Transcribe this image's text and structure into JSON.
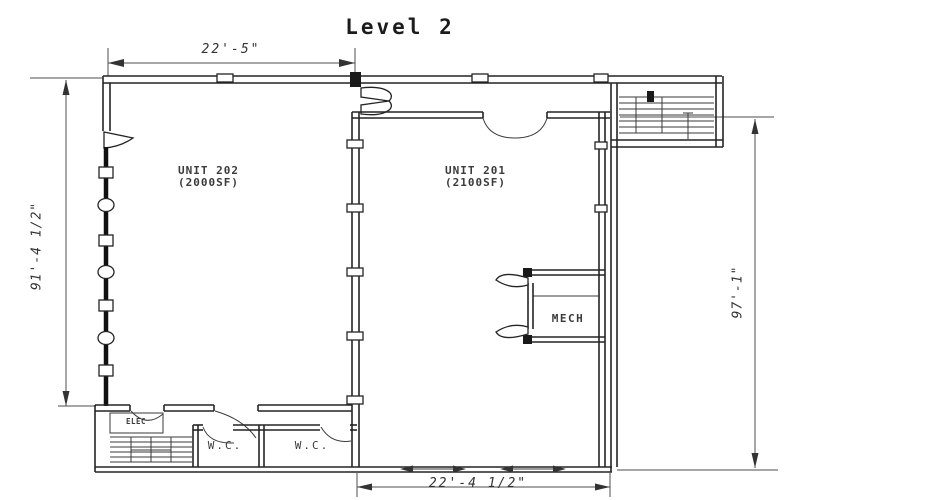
{
  "title": "Level 2",
  "dimensions": {
    "top": "22'-5\"",
    "left": "91'-4 1/2\"",
    "right": "97'-1\"",
    "bottom": "22'-4 1/2\""
  },
  "units": {
    "unit202": {
      "name": "UNIT 202",
      "area": "(2000SF)"
    },
    "unit201": {
      "name": "UNIT 201",
      "area": "(2100SF)"
    }
  },
  "rooms": {
    "mech": "MECH",
    "elec": "ELEC",
    "wc_left": "W.C.",
    "wc_right": "W.C."
  },
  "colors": {
    "background": "#ffffff",
    "wall_line": "#242424",
    "dimension_line": "#4d4d4d",
    "text": "#3b3b3b"
  }
}
